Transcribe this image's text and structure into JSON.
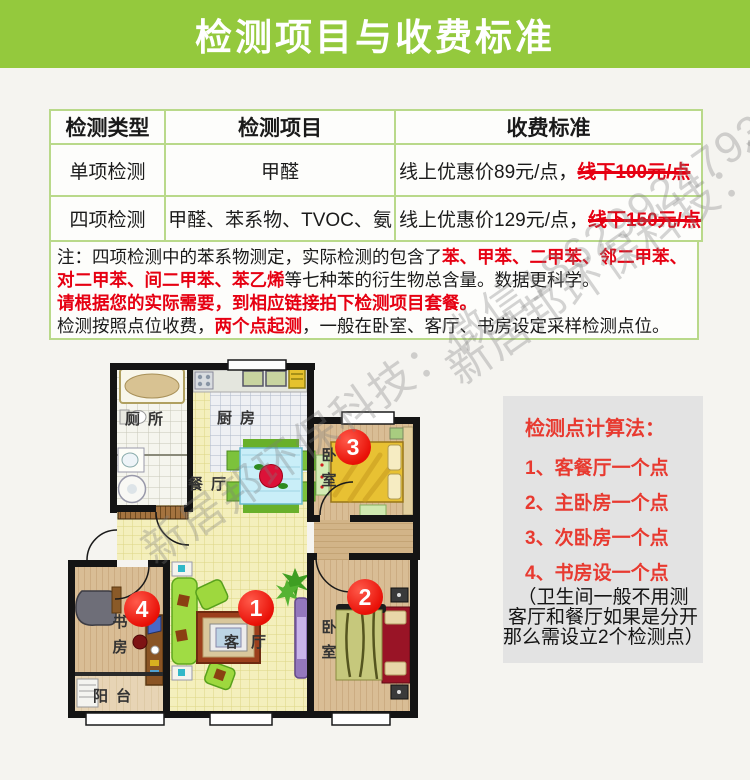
{
  "header": {
    "title": "检测项目与收费标准"
  },
  "table": {
    "headers": [
      "检测类型",
      "检测项目",
      "收费标准"
    ],
    "rows": [
      {
        "type": "单项检测",
        "items": "甲醛",
        "price": "线上优惠价89元/点，",
        "price_struck": "线下100元/点"
      },
      {
        "type": "四项检测",
        "items": "甲醛、苯系物、TVOC、氨",
        "price": "线上优惠价129元/点，",
        "price_struck": "线下150元/点"
      }
    ]
  },
  "note": {
    "seg1": "注：四项检测中的苯系物测定，实际检测的包含了",
    "seg1_red": "苯、甲苯、二甲苯、邻二甲苯、对二甲苯、间二甲苯、苯乙烯",
    "seg1_end": "等七种苯的衍生物总含量。数据更科学。",
    "line2_red": "请根据您的实际需要，到相应链接拍下检测项目套餐。",
    "line3_a": "检测按照点位收费，",
    "line3_red": "两个点起测",
    "line3_b": "，一般在卧室、客厅、书房设定采样检测点位。"
  },
  "panel": {
    "title": "检测点计算法：",
    "items": [
      "1、客餐厅一个点",
      "2、主卧房一个点",
      "3、次卧房一个点",
      "4、书房设一个点"
    ],
    "footnote": [
      "（卫生间一般不用测",
      "客厅和餐厅如果是分开",
      "那么需设立2个检测点）"
    ]
  },
  "floorplan": {
    "rooms": {
      "bathroom": "厕所",
      "kitchen": "厨房",
      "dining": "餐厅",
      "bedroom_top": "卧室",
      "bedroom_bottom": "卧室",
      "living": "客厅",
      "study": "书房",
      "balcony": "阳台"
    },
    "markers": [
      "1",
      "2",
      "3",
      "4"
    ]
  },
  "watermark": {
    "text": "新居邦环保科技：微信18629924793"
  },
  "colors": {
    "header_green": "#94c93d",
    "table_border_green": "#b9d98a",
    "note_red": "#e60012",
    "panel_red": "#e83a30",
    "marker_red": "#e80f06",
    "panel_gray": "#e3e3e3"
  }
}
